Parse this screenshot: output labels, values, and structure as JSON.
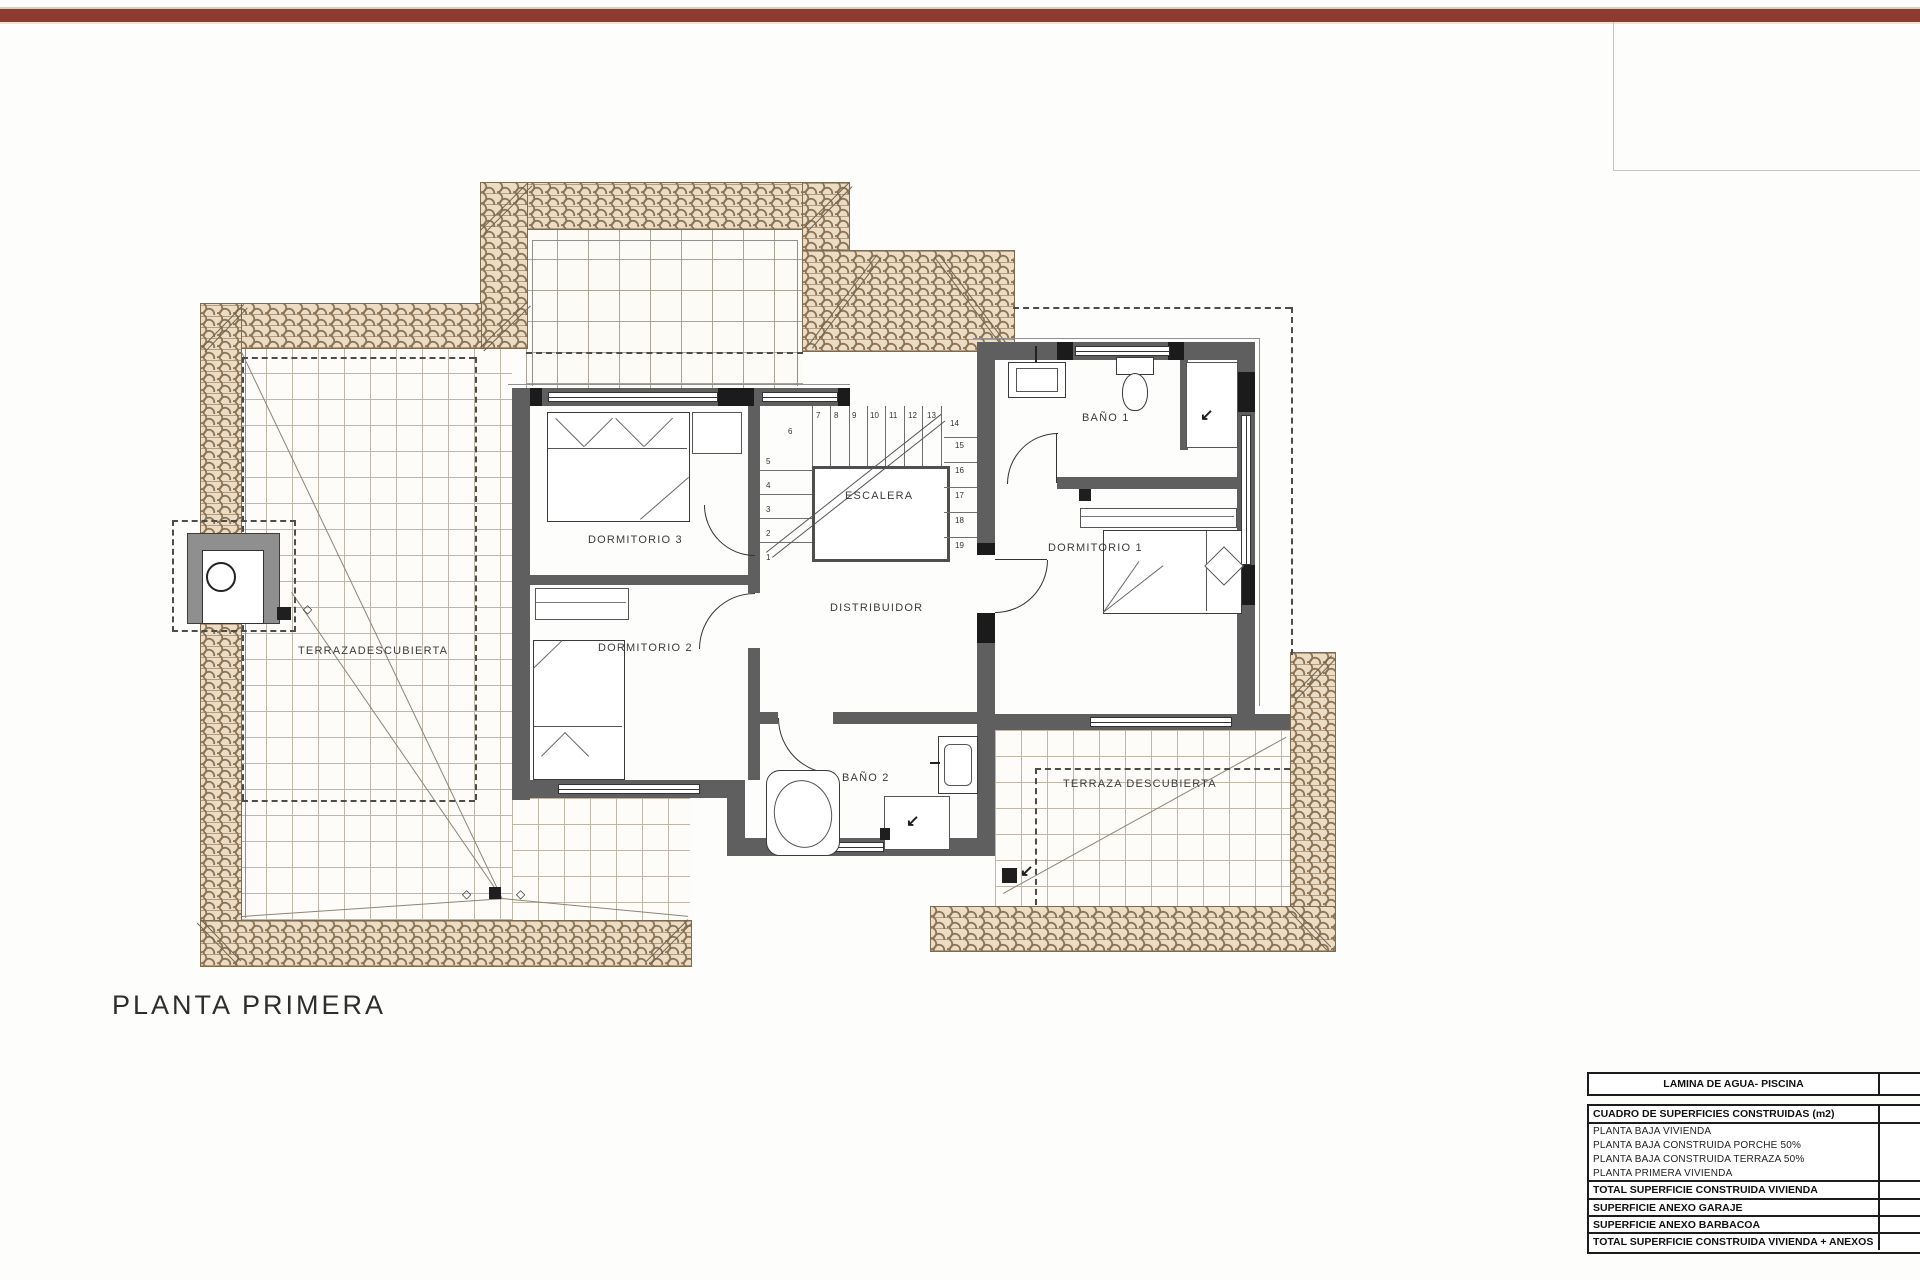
{
  "page": {
    "title_label": "PLANTA PRIMERA"
  },
  "colors": {
    "banner_red": "#8d3b31",
    "tile_fill": "#ecdcc3",
    "tile_line": "#8a7254",
    "wall_gray": "#5f5f5f",
    "jamb_black": "#1b1b1b",
    "grid_line": "#bfb8a9",
    "dashed_line": "#4c4c4c",
    "label_text": "#3b3b3b"
  },
  "rooms": {
    "dormitorio3": "DORMITORIO 3",
    "dormitorio2": "DORMITORIO 2",
    "dormitorio1": "DORMITORIO 1",
    "bano1": "BAÑO 1",
    "bano2": "BAÑO 2",
    "escalera": "ESCALERA",
    "distribuidor": "DISTRIBUIDOR",
    "terraza_izquierda": "TERRAZADESCUBIERTA",
    "terraza_derecha": "TERRAZA DESCUBIERTA"
  },
  "stairs": {
    "top": [
      "6",
      "7",
      "8",
      "9",
      "10",
      "11",
      "12",
      "13"
    ],
    "right": [
      "14",
      "15",
      "16",
      "17",
      "18",
      "19"
    ],
    "left": [
      "5",
      "4",
      "3",
      "2",
      "1"
    ]
  },
  "markers": {
    "diamond": "◇",
    "arrow_sw": "↙"
  },
  "tables": {
    "lamina": {
      "label": "LAMINA DE AGUA- PISCINA",
      "value": ""
    },
    "cuadro": {
      "header": "CUADRO DE SUPERFICIES CONSTRUIDAS (m2)",
      "header_value": "",
      "rows": [
        {
          "label": "PLANTA BAJA VIVIENDA",
          "value": ""
        },
        {
          "label": "PLANTA BAJA CONSTRUIDA PORCHE 50%",
          "value": ""
        },
        {
          "label": "PLANTA BAJA CONSTRUIDA TERRAZA 50%",
          "value": ""
        },
        {
          "label": "PLANTA PRIMERA VIVIENDA",
          "value": ""
        },
        {
          "label": "TOTAL SUPERFICIE CONSTRUIDA VIVIENDA",
          "value": ""
        },
        {
          "label": "SUPERFICIE ANEXO GARAJE",
          "value": ""
        },
        {
          "label": "SUPERFICIE ANEXO BARBACOA",
          "value": ""
        },
        {
          "label": "TOTAL SUPERFICIE CONSTRUIDA VIVIENDA + ANEXOS",
          "value": ""
        }
      ]
    }
  }
}
